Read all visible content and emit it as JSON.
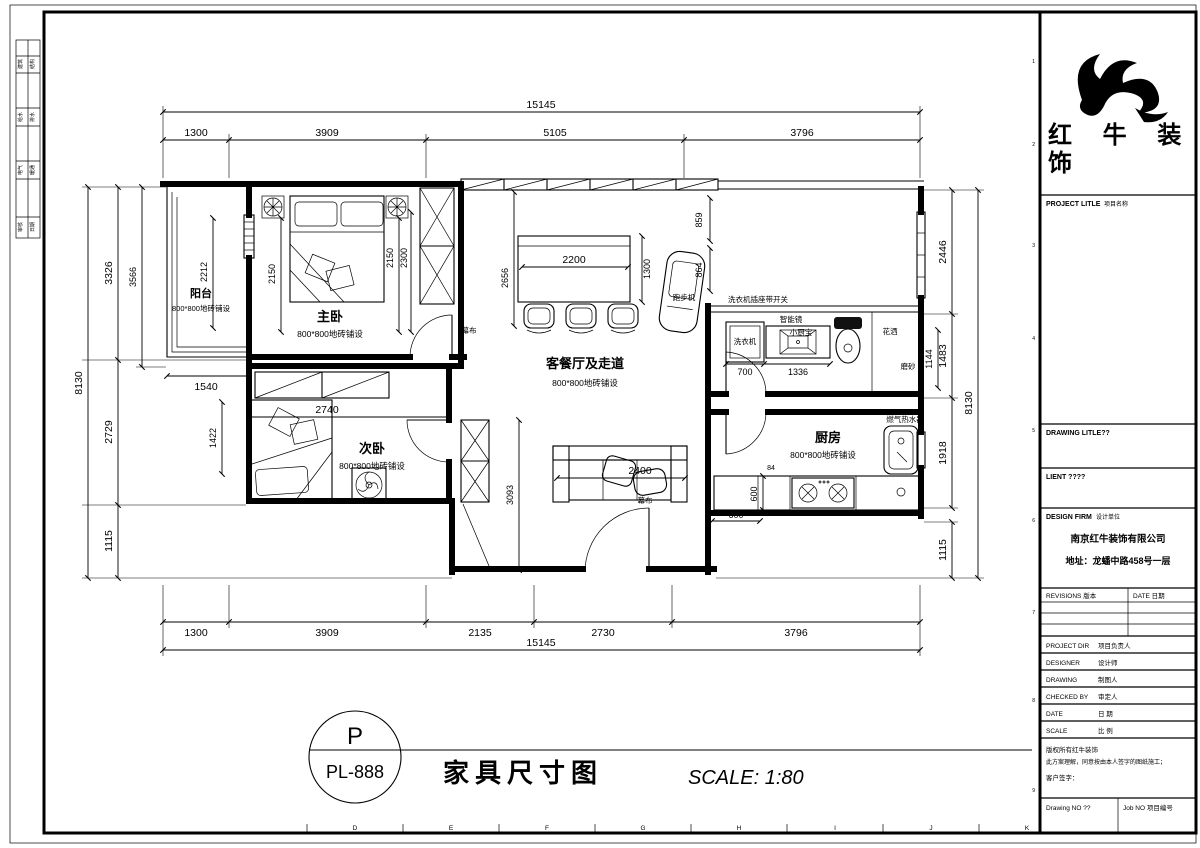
{
  "sheet": {
    "left_table": {
      "rows": [
        [
          "建筑",
          "结构"
        ],
        [
          "给水",
          "排水"
        ],
        [
          "电气",
          "暖通"
        ],
        [
          "审核",
          "日期"
        ]
      ]
    },
    "bottom_ruler": [
      "D",
      "E",
      "F",
      "G",
      "H",
      "I",
      "J",
      "K"
    ],
    "right_ruler": [
      "1",
      "2",
      "3",
      "4",
      "5",
      "6",
      "7",
      "8",
      "9"
    ]
  },
  "title_block": {
    "brand_line1": "红 牛 装",
    "brand_line2": "饰",
    "project_title_en": "PROJECT LITLE",
    "project_title_cn": "项目名称",
    "drawing_title_en": "DRAWING LITLE??",
    "client_en": "LIENT ????",
    "design_firm_en": "DESIGN FIRM",
    "design_firm_cn": "设计单位",
    "firm_name": "南京红牛装饰有限公司",
    "firm_address": "地址：龙蟠中路458号一层",
    "revisions_label": "REVISIONS 版本",
    "date_label": "DATE 日期",
    "rows": [
      {
        "en": "PROJECT DIR",
        "cn": "项目负责人"
      },
      {
        "en": "DESIGNER",
        "cn": "设计师"
      },
      {
        "en": "DRAWING",
        "cn": "制图人"
      },
      {
        "en": "CHECKED BY",
        "cn": "审定人"
      },
      {
        "en": "DATE",
        "cn": "日 期"
      },
      {
        "en": "SCALE",
        "cn": "比 例"
      }
    ],
    "copyright1": "版权所有红牛装饰",
    "copyright2": "此方案理解，同意按由本人签字的图纸施工；",
    "copyright3": "客户签字：",
    "drawing_no_label": "Drawing NO ??",
    "job_no_label": "Job NO 项目编号"
  },
  "footer": {
    "stamp_top": "P",
    "stamp_bottom": "PL-888",
    "title": "家具尺寸图",
    "scale": "SCALE: 1:80"
  },
  "plan": {
    "rooms": {
      "balcony": {
        "name": "阳台",
        "floor": "800*800地砖铺设"
      },
      "master": {
        "name": "主卧",
        "floor": "800*800地砖铺设"
      },
      "second": {
        "name": "次卧",
        "floor": "800*800地砖铺设"
      },
      "living": {
        "name": "客餐厅及走道",
        "floor": "800*800地砖铺设"
      },
      "kitchen": {
        "name": "厨房",
        "floor": "800*800地砖铺设"
      }
    },
    "labels": {
      "treadmill": "跑步机",
      "curtain1": "幕布",
      "curtain2": "幕布",
      "washer_socket": "洗衣机插座带开关",
      "smart_mirror": "智能镜",
      "washer": "洗衣机",
      "water_heater_small": "小厨宝",
      "shower": "花洒",
      "frosted": "磨砂",
      "gas_heater": "燃气热水器"
    },
    "dims": {
      "top_total": "15145",
      "t1": "1300",
      "t2": "3909",
      "t3": "5105",
      "t4": "3796",
      "b1": "1300",
      "b2": "3909",
      "b3": "2135",
      "b4": "2730",
      "b5": "3796",
      "bottom_total": "15145",
      "left_total": "8130",
      "l1": "3326",
      "l1_inner": "3566",
      "l2": "2729",
      "l3": "1115",
      "balcony_h": "2212",
      "balcony_w": "1540",
      "bed2_left": "1422",
      "right_total": "8130",
      "r1": "2446",
      "r2": "1483",
      "r3": "1918",
      "r4": "1115",
      "bath_side": "1144",
      "m_left": "2150",
      "m_right": "2150",
      "m_right2": "2300",
      "living_depth": "2656",
      "table_w": "2200",
      "table_h": "1300",
      "tread_a": "859",
      "tread_b": "864",
      "bath_a": "700",
      "bath_b": "1336",
      "bed2_w": "2740",
      "hall_h": "3093",
      "sofa_w": "2400",
      "k_a": "84",
      "k_b": "600",
      "k_c": "600"
    }
  }
}
